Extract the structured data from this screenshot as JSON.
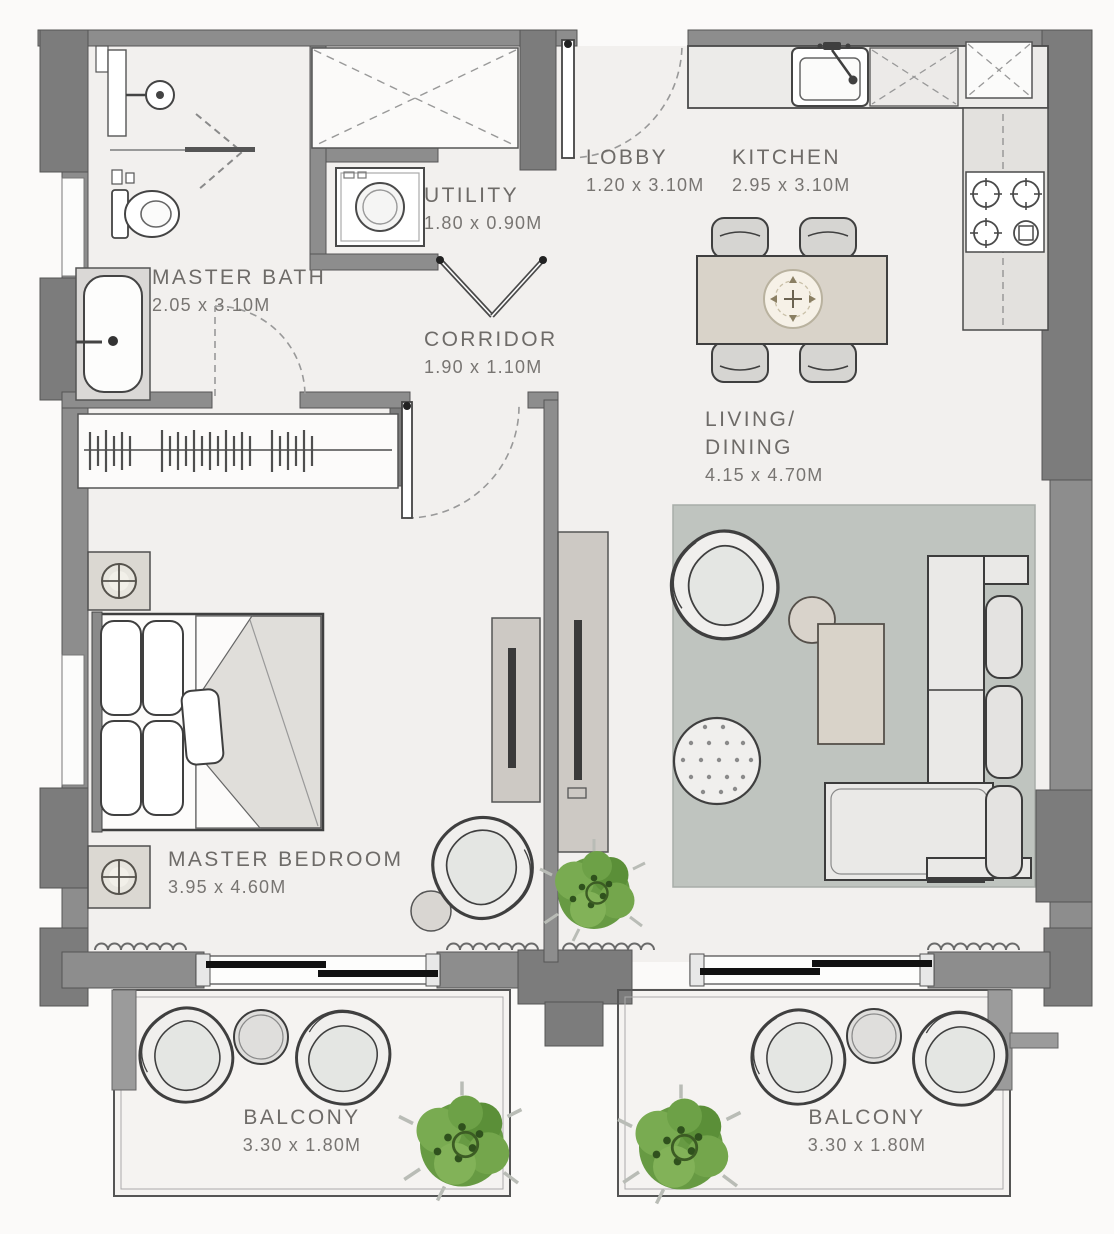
{
  "plan_title": "Apartment Floor Plan",
  "rooms": [
    {
      "id": "master-bath",
      "lines": [
        "MASTER BATH"
      ],
      "dims": "2.05 x 3.10M"
    },
    {
      "id": "utility",
      "lines": [
        "UTILITY"
      ],
      "dims": "1.80 x 0.90M"
    },
    {
      "id": "lobby",
      "lines": [
        "LOBBY"
      ],
      "dims": "1.20 x 3.10M"
    },
    {
      "id": "kitchen",
      "lines": [
        "KITCHEN"
      ],
      "dims": "2.95 x 3.10M"
    },
    {
      "id": "corridor",
      "lines": [
        "CORRIDOR"
      ],
      "dims": "1.90 x 1.10M"
    },
    {
      "id": "living-dining",
      "lines": [
        "LIVING/",
        "DINING"
      ],
      "dims": "4.15 x 4.70M"
    },
    {
      "id": "master-bedroom",
      "lines": [
        "MASTER BEDROOM"
      ],
      "dims": "3.95 x 4.60M"
    },
    {
      "id": "balcony-left",
      "lines": [
        "BALCONY"
      ],
      "dims": "3.30 x 1.80M"
    },
    {
      "id": "balcony-right",
      "lines": [
        "BALCONY"
      ],
      "dims": "3.30 x 1.80M"
    }
  ],
  "icons": [
    "bathtub-icon",
    "toilet-icon",
    "shower-icon",
    "washing-machine-icon",
    "wardrobe-x-icon",
    "hanger-rail-icon",
    "kitchen-sink-icon",
    "stove-icon",
    "fridge-x-icon",
    "dining-table-icon",
    "dining-chair-icon",
    "table-centerpiece-icon",
    "bed-icon",
    "nightstand-lamp-icon",
    "tv-icon",
    "sofa-icon",
    "armchair-icon",
    "coffee-table-icon",
    "side-table-icon",
    "pouf-icon",
    "rug-icon",
    "lounge-chair-icon",
    "plant-icon",
    "sliding-door-icon",
    "door-swing-icon",
    "curtain-icon"
  ],
  "colors": {
    "wall": "#8d8d8d",
    "wall_dark": "#7c7c7c",
    "floor": "#f2f0ee",
    "rug": "#bfc4bf",
    "wood": "#d9d3c9",
    "plant_green": "#679a43",
    "text": "#6e6b68",
    "outline": "#3f3f3f"
  }
}
